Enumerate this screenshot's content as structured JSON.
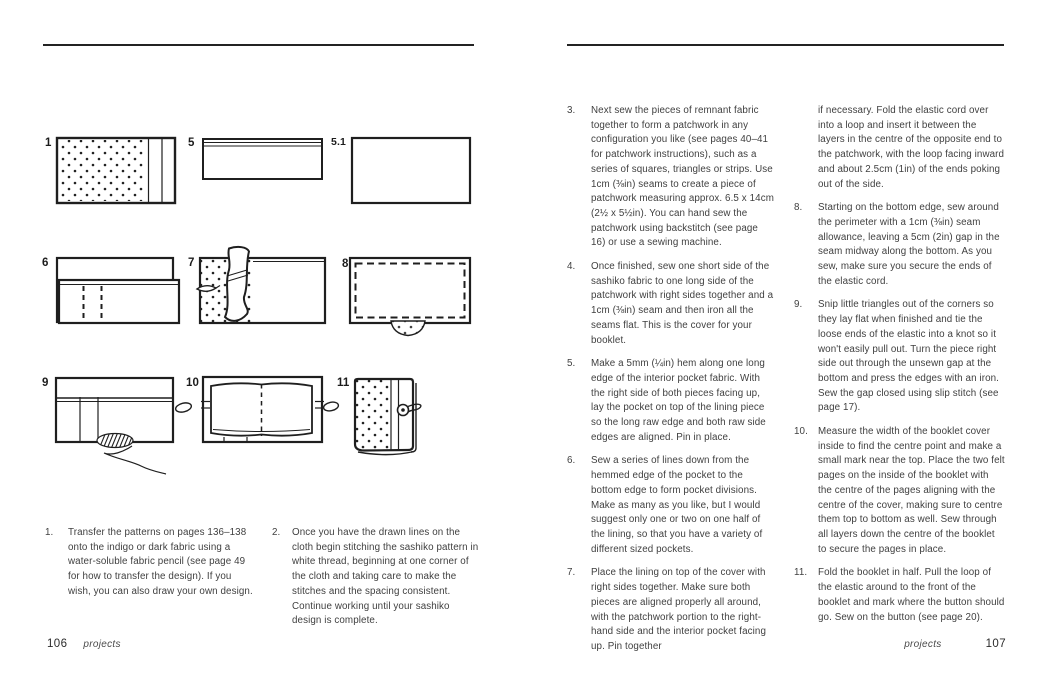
{
  "left_page": {
    "page_number": "106",
    "footer_label": "projects",
    "figure_labels": {
      "f1": "1",
      "f5": "5",
      "f5_1": "5.1",
      "f6": "6",
      "f7": "7",
      "f8": "8",
      "f9": "9",
      "f10": "10",
      "f11": "11"
    },
    "steps": [
      {
        "num": "1.",
        "text": "Transfer the patterns on pages 136–138 onto the indigo or dark fabric using a water-soluble fabric pencil (see page 49 for how to transfer the design). If you wish, you can also draw your own design."
      },
      {
        "num": "2.",
        "text": "Once you have the drawn lines on the cloth begin stitching the sashiko pattern in white thread, beginning at one corner of the cloth and taking care to make the stitches and the spacing consistent. Continue working until your sashiko design is complete."
      }
    ]
  },
  "right_page": {
    "page_number": "107",
    "footer_label": "projects",
    "column1_steps": [
      {
        "num": "3.",
        "text": "Next sew the pieces of remnant fabric together to form a patchwork in any configuration you like (see pages 40–41 for patchwork instructions), such as a series of squares, triangles or strips. Use 1cm (⅜in) seams to create a piece of patchwork measuring approx. 6.5 x 14cm (2½ x 5½in). You can hand sew the patchwork using backstitch (see page 16) or use a sewing machine."
      },
      {
        "num": "4.",
        "text": "Once finished, sew one short side of the sashiko fabric to one long side of the patchwork with right sides together and a 1cm (⅜in) seam and then iron all the seams flat. This is the cover for your booklet."
      },
      {
        "num": "5.",
        "text": "Make a 5mm (¼in) hem along one long edge of the interior pocket fabric. With the right side of both pieces facing up, lay the pocket on top of the lining piece so the long raw edge and both raw side edges are aligned. Pin in place."
      },
      {
        "num": "6.",
        "text": "Sew a series of lines down from the hemmed edge of the pocket to the bottom edge to form pocket divisions. Make as many as you like, but I would suggest only one or two on one half of the lining, so that you have a variety of different sized pockets."
      },
      {
        "num": "7.",
        "text": "Place the lining on top of the cover with right sides together. Make sure both pieces are aligned properly all around, with the patchwork portion to the right-hand side and the interior pocket facing up. Pin together"
      }
    ],
    "column2_continuation": "if necessary. Fold the elastic cord over into a loop and insert it between the layers in the centre of the opposite end to the patchwork, with the loop facing inward and about 2.5cm (1in) of the ends poking out of the side.",
    "column2_steps": [
      {
        "num": "8.",
        "text": "Starting on the bottom edge, sew around the perimeter with a 1cm (⅜in) seam allowance, leaving a 5cm (2in) gap in the seam midway along the bottom. As you sew, make sure you secure the ends of the elastic cord."
      },
      {
        "num": "9.",
        "text": "Snip little triangles out of the corners so they lay flat when finished and tie the loose ends of the elastic into a knot so it won't easily pull out. Turn the piece right side out through the unsewn gap at the bottom and press the edges with an iron. Sew the gap closed using slip stitch (see page 17)."
      },
      {
        "num": "10.",
        "text": "Measure the width of the booklet cover inside to find the centre point and make a small mark near the top. Place the two felt pages on the inside of the booklet with the centre of the pages aligning with the centre of the cover, making sure to centre them top to bottom as well. Sew through all layers down the centre of the booklet to secure the pages in place."
      },
      {
        "num": "11.",
        "text": "Fold the booklet in half. Pull the loop of the elastic around to the front of the booklet and mark where the button should go. Sew on the button (see page 20)."
      }
    ]
  }
}
